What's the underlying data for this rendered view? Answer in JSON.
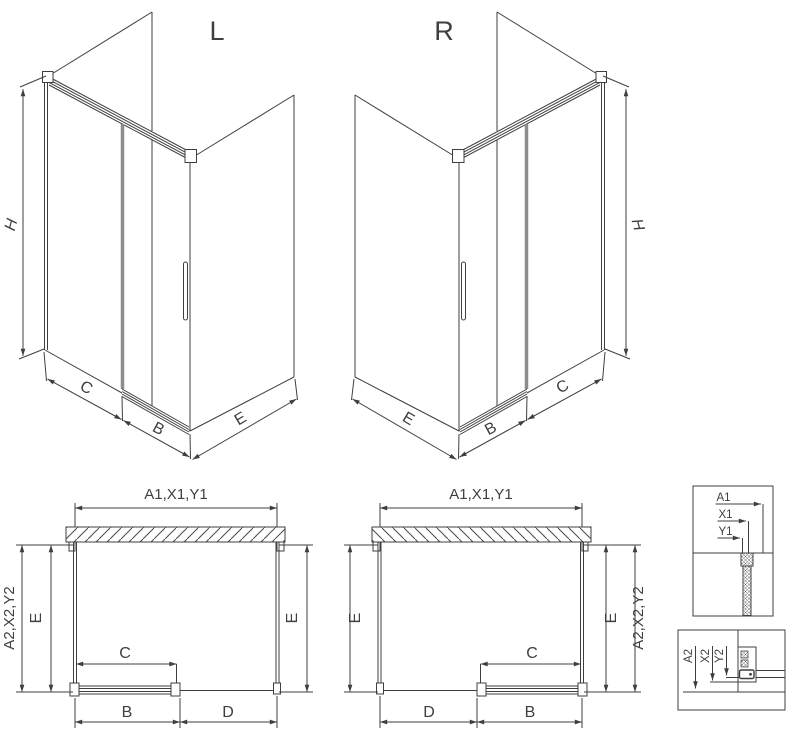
{
  "colors": {
    "line": "#3f3f3f",
    "profile_gray": "#8d8d8d",
    "background": "#ffffff"
  },
  "iso_left": {
    "label": "L",
    "height_dim": "H",
    "back_dim": "C",
    "door_dim": "B",
    "side_dim": "E"
  },
  "iso_right": {
    "label": "R",
    "height_dim": "H",
    "back_dim": "C",
    "door_dim": "B",
    "side_dim": "E"
  },
  "plan_left": {
    "width_dim": "A1,X1,Y1",
    "outer_dim": "A2,X2,Y2",
    "left_depth_dim": "E",
    "right_depth_dim": "E",
    "door_dim": "C",
    "door_width_dim": "B",
    "open_dim": "D"
  },
  "plan_right": {
    "width_dim": "A1,X1,Y1",
    "outer_dim": "A2,X2,Y2",
    "left_depth_dim": "E",
    "right_depth_dim": "E",
    "door_dim": "C",
    "door_width_dim": "B",
    "open_dim": "D"
  },
  "detail_top": {
    "dims": [
      "A1",
      "X1",
      "Y1"
    ]
  },
  "detail_bottom": {
    "dims": [
      "A2",
      "X2",
      "Y2"
    ]
  }
}
